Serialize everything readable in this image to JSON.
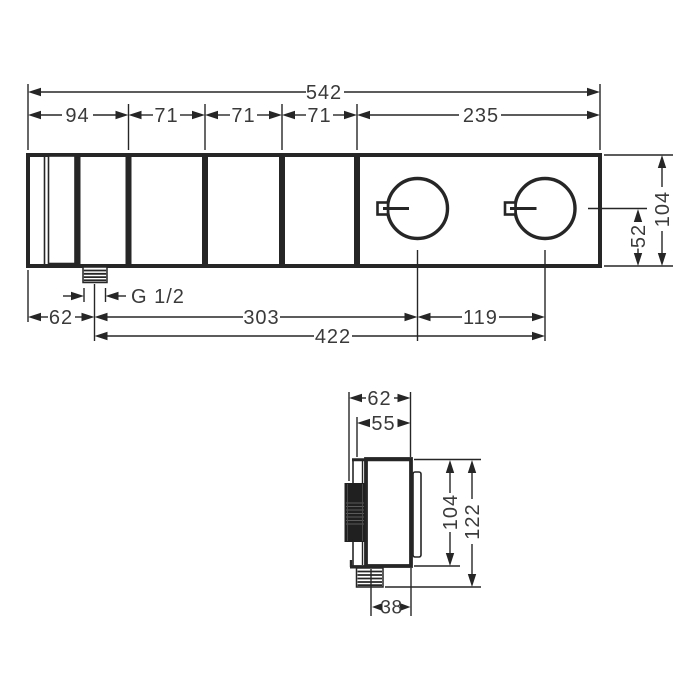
{
  "colors": {
    "line-color": "#262626",
    "text-color": "#3a3a3a",
    "background": "#ffffff"
  },
  "front_view": {
    "total_width": "542",
    "segments": [
      "94",
      "71",
      "71",
      "71",
      "235"
    ],
    "height": "104",
    "knob_center_from_bottom": "52",
    "thread": "G 1/2",
    "outlet_from_left": "62",
    "outlet_to_first_knob": "303",
    "knob_spacing": "119",
    "outlet_to_second_knob": "422"
  },
  "side_view": {
    "depth_with_handle": "62",
    "depth_body": "55",
    "body_height": "104",
    "total_height": "122",
    "outlet_from_wall": "38"
  }
}
